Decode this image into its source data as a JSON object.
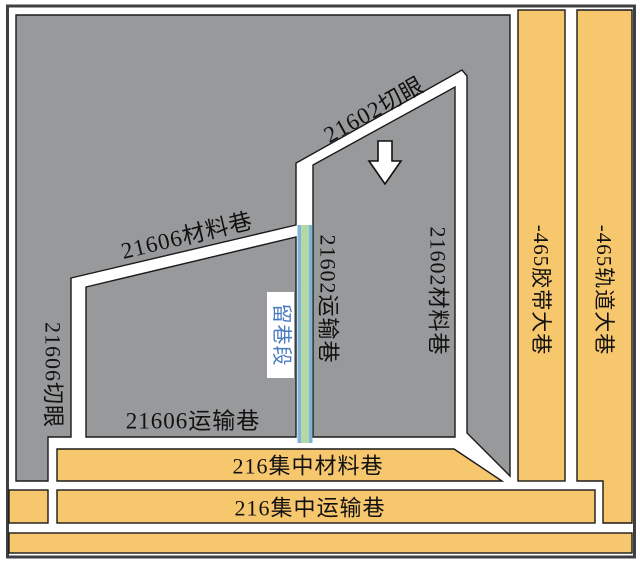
{
  "colors": {
    "panel_gray": "#98999b",
    "roadway_orange": "#f7c76e",
    "retained_green": "#b3d8a6",
    "retained_blue": "#7fb3d9",
    "retained_label_blue": "#4a7abf",
    "outline_black": "#1a1a1a",
    "frame_dark": "#3f3f41",
    "roadway_white": "#ffffff"
  },
  "icons": {
    "direction_arrow": "down-arrow"
  },
  "labels": {
    "cut_21602": "21602切眼",
    "material_21606": "21606材料巷",
    "cut_21606": "21606切眼",
    "transport_21602": "21602运输巷",
    "material_21602": "21602材料巷",
    "belt_465": "-465胶带大巷",
    "track_465": "-465轨道大巷",
    "retained_section": "留巷段",
    "transport_21606": "21606运输巷",
    "central_material_216": "216集中材料巷",
    "central_transport_216": "216集中运输巷"
  }
}
